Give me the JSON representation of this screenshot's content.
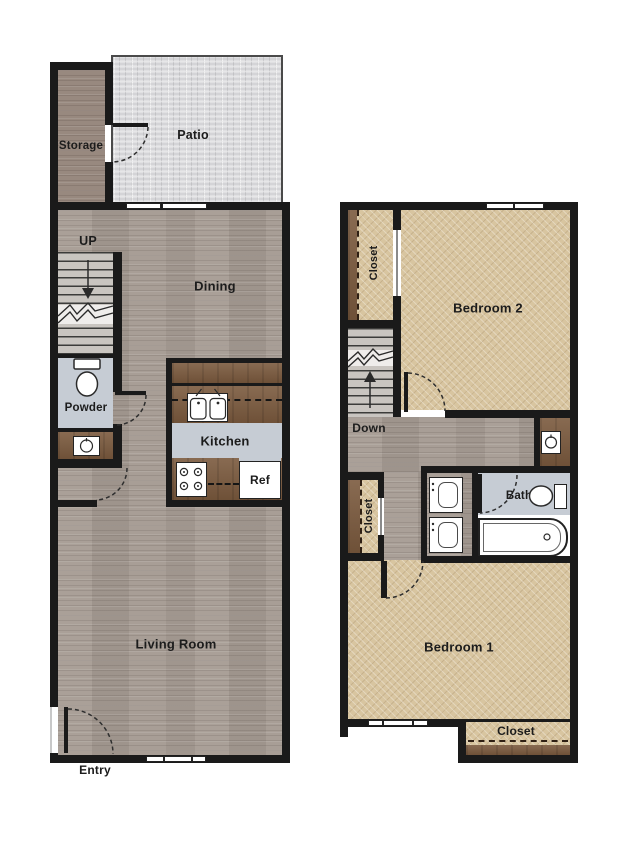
{
  "title": "Two-story townhouse floor plan",
  "floor1": {
    "rooms": {
      "storage": "Storage",
      "patio": "Patio",
      "dining": "Dining",
      "powder": "Powder",
      "kitchen": "Kitchen",
      "living_room": "Living Room"
    },
    "labels": {
      "up": "UP",
      "entry": "Entry",
      "ref": "Ref"
    }
  },
  "floor2": {
    "rooms": {
      "closet_upper": "Closet",
      "bedroom2": "Bedroom 2",
      "closet_hall": "Closet",
      "bath": "Bath",
      "bedroom1": "Bedroom 1",
      "closet_bedroom1": "Closet"
    },
    "labels": {
      "down": "Down"
    }
  },
  "colors": {
    "wall": "#1a1a1a",
    "wood_floor": "#a59b93",
    "wood_floor_dark": "#98897f",
    "carpet": "#d8c5a0",
    "tile_floor": "#c6ccd4",
    "counter_brown": "#7b5a3e",
    "patio_tile": "#e0e0e2"
  }
}
